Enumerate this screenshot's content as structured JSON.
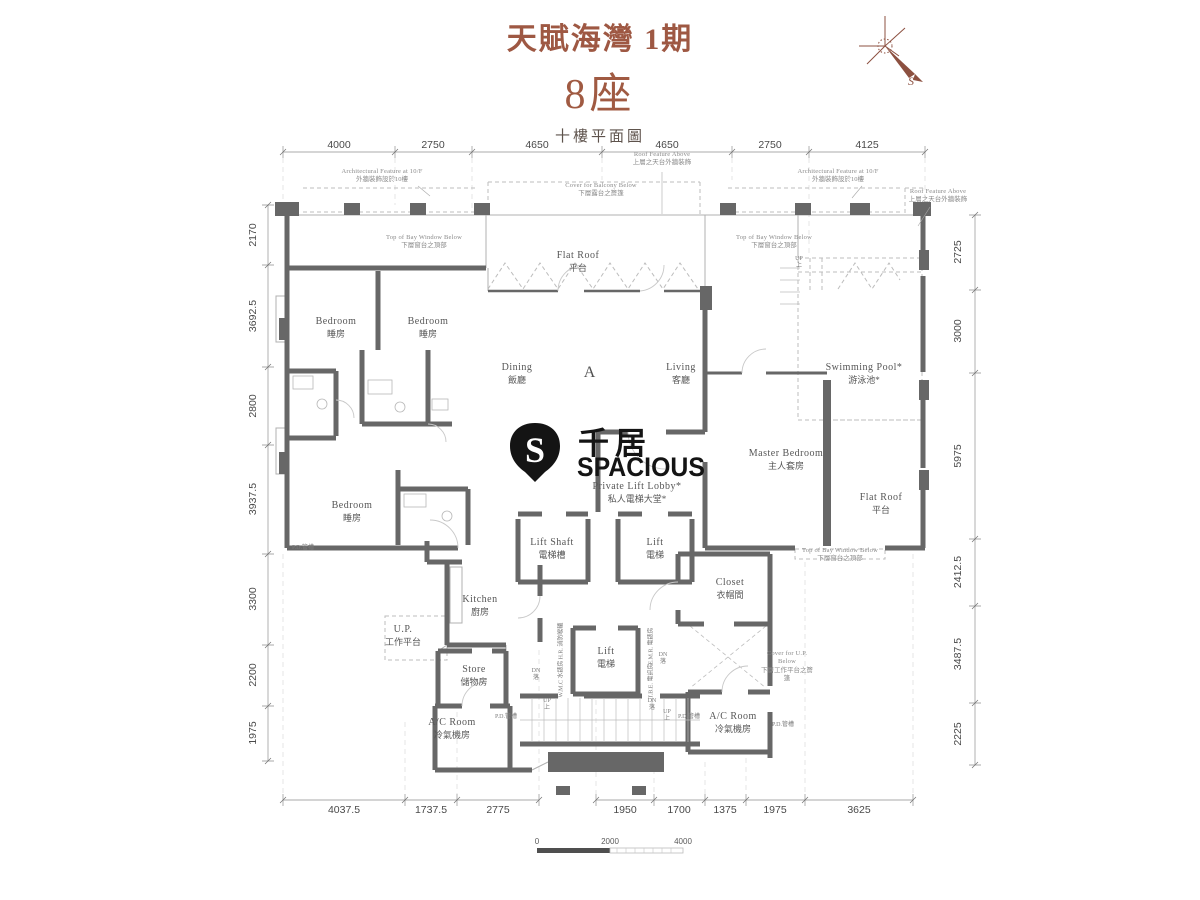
{
  "header": {
    "project": "天賦海灣 1期",
    "tower": "8座",
    "floor": "十樓平面圖"
  },
  "compass": {
    "south": "S"
  },
  "logo": {
    "badge_letter": "S",
    "cjk": "千居",
    "latin": "SPACIOUS"
  },
  "unit": {
    "flat": "A"
  },
  "colors": {
    "accent": "#9e5843",
    "wall": "#676767",
    "dim_text": "#4a4a4a",
    "label_text": "#565656"
  },
  "dimensions": {
    "top": [
      "4000",
      "2750",
      "4650",
      "4650",
      "2750",
      "4125"
    ],
    "left": [
      "2170",
      "3692.5",
      "2800",
      "3937.5",
      "3300",
      "2200",
      "1975"
    ],
    "right": [
      "2725",
      "3000",
      "5975",
      "2412.5",
      "3487.5",
      "2225"
    ],
    "bottom_left": [
      "4037.5",
      "1737.5",
      "2775"
    ],
    "bottom_right": [
      "1950",
      "1700",
      "1375",
      "1975",
      "3625"
    ]
  },
  "scale_bar": {
    "start": "0",
    "mid": "2000",
    "end": "4000"
  },
  "rooms": {
    "bedroom_a": {
      "en": "Bedroom",
      "zh": "睡房"
    },
    "bedroom_b": {
      "en": "Bedroom",
      "zh": "睡房"
    },
    "bedroom_c": {
      "en": "Bedroom",
      "zh": "睡房"
    },
    "dining": {
      "en": "Dining",
      "zh": "飯廳"
    },
    "living": {
      "en": "Living",
      "zh": "客廳"
    },
    "master_bedroom": {
      "en": "Master Bedroom",
      "zh": "主人套房"
    },
    "swimming_pool": {
      "en": "Swimming Pool*",
      "zh": "游泳池*"
    },
    "flat_roof_top": {
      "en": "Flat Roof",
      "zh": "平台"
    },
    "flat_roof_right": {
      "en": "Flat Roof",
      "zh": "平台"
    },
    "private_lift_lobby": {
      "en": "Private Lift Lobby*",
      "zh": "私人電梯大堂*"
    },
    "lift_shaft": {
      "en": "Lift Shaft",
      "zh": "電梯槽"
    },
    "lift_upper": {
      "en": "Lift",
      "zh": "電梯"
    },
    "lift_lower": {
      "en": "Lift",
      "zh": "電梯"
    },
    "kitchen": {
      "en": "Kitchen",
      "zh": "廚房"
    },
    "utility_platform": {
      "en": "U.P.",
      "zh": "工作平台"
    },
    "store": {
      "en": "Store",
      "zh": "儲物房"
    },
    "closet": {
      "en": "Closet",
      "zh": "衣帽間"
    },
    "ac_room_left": {
      "en": "A/C Room",
      "zh": "冷氣機房"
    },
    "ac_room_right": {
      "en": "A/C Room",
      "zh": "冷氣機房"
    }
  },
  "annotations": {
    "arch_feature_left": {
      "en": "Architectural Feature at 10/F",
      "zh": "外牆裝飾設於10樓"
    },
    "arch_feature_right": {
      "en": "Architectural Feature at 10/F",
      "zh": "外牆裝飾設於10樓"
    },
    "roof_feature_top": {
      "en": "Roof Feature Above",
      "zh": "上層之天台外牆裝飾"
    },
    "roof_feature_corner": {
      "en": "Roof Feature Above",
      "zh": "上層之天台外牆裝飾"
    },
    "cover_balcony": {
      "en": "Cover for Balcony Below",
      "zh": "下層露台之簷篷"
    },
    "bay_window_left": {
      "en": "Top of Bay Window Below",
      "zh": "下層窗台之頂部"
    },
    "bay_window_right": {
      "en": "Top of Bay Window Below",
      "zh": "下層窗台之頂部"
    },
    "bay_window_bottom": {
      "en": "Top of Bay Window Below",
      "zh": "下層窗台之頂部"
    },
    "cover_up": {
      "en": "Cover for U.P. Below",
      "zh": "下層工作平台之簷篷"
    }
  },
  "small_labels": {
    "pd": "P.D.管槽",
    "hose_reel": "H.R. 消防喉轆",
    "water_meter": "W.M.C 水錶房",
    "elec_meter": "E.M.R. 電錶房",
    "telecom": "T.B.E. 電訊房",
    "up_en": "UP",
    "up_zh": "上",
    "dn_en": "DN",
    "dn_zh": "落"
  }
}
